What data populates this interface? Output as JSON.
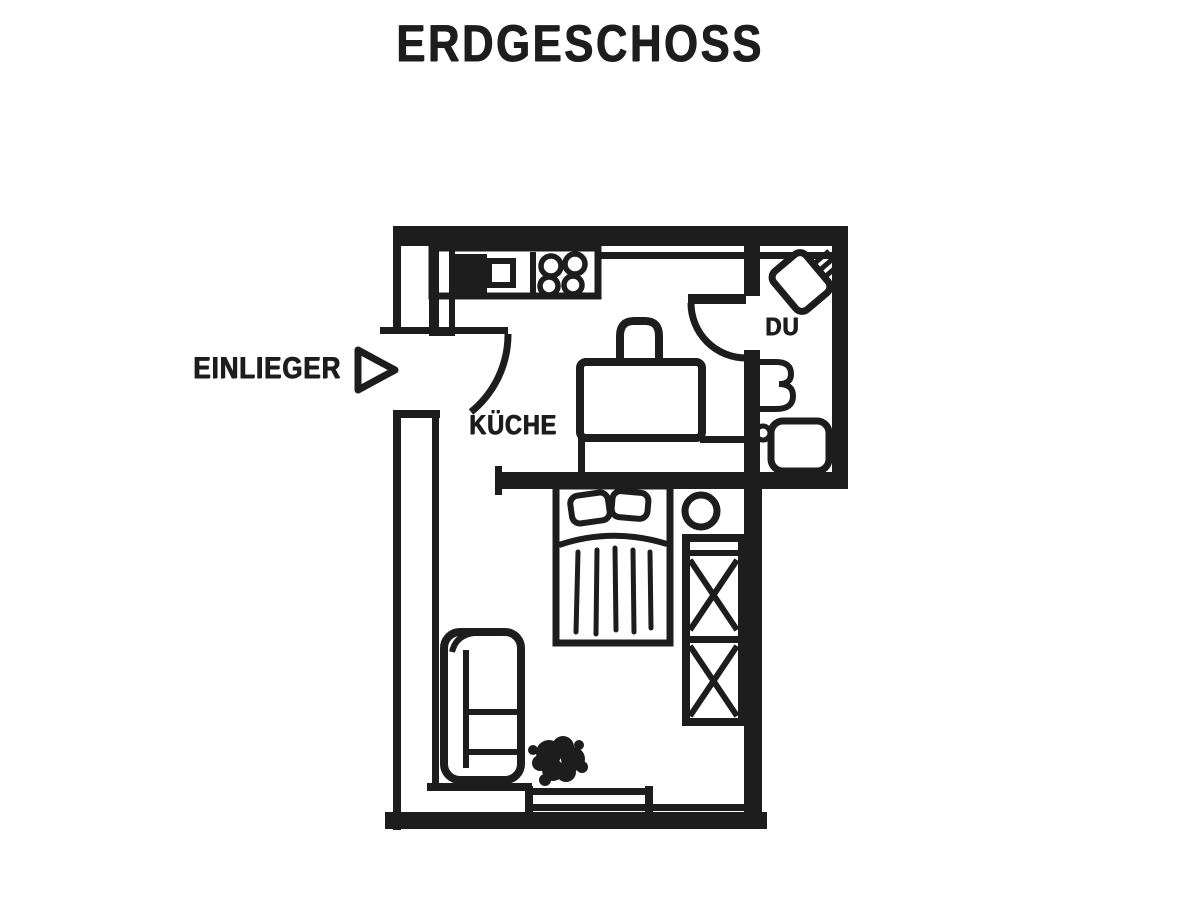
{
  "page": {
    "background": "#ffffff",
    "ink": "#1d1d1d",
    "description_title": "ERDGESCHOSS"
  },
  "title": "ERDGESCHOSS",
  "labels": {
    "annex": "EINLIEGER",
    "kitchen": "KÜCHE",
    "shower_room": "DU"
  },
  "icons": [
    "entrance-arrow-icon",
    "entrance-door-icon",
    "kitchen-counter-icon",
    "sink-icon",
    "stove-icon",
    "chair-icon",
    "table-icon",
    "bathroom-door-icon",
    "shower-tray-icon",
    "washbasin-icon",
    "wc-icon",
    "bed-icon",
    "pillow-icon",
    "stool-icon",
    "wardrobe-icon",
    "sofa-icon",
    "plant-icon",
    "window-icon"
  ]
}
